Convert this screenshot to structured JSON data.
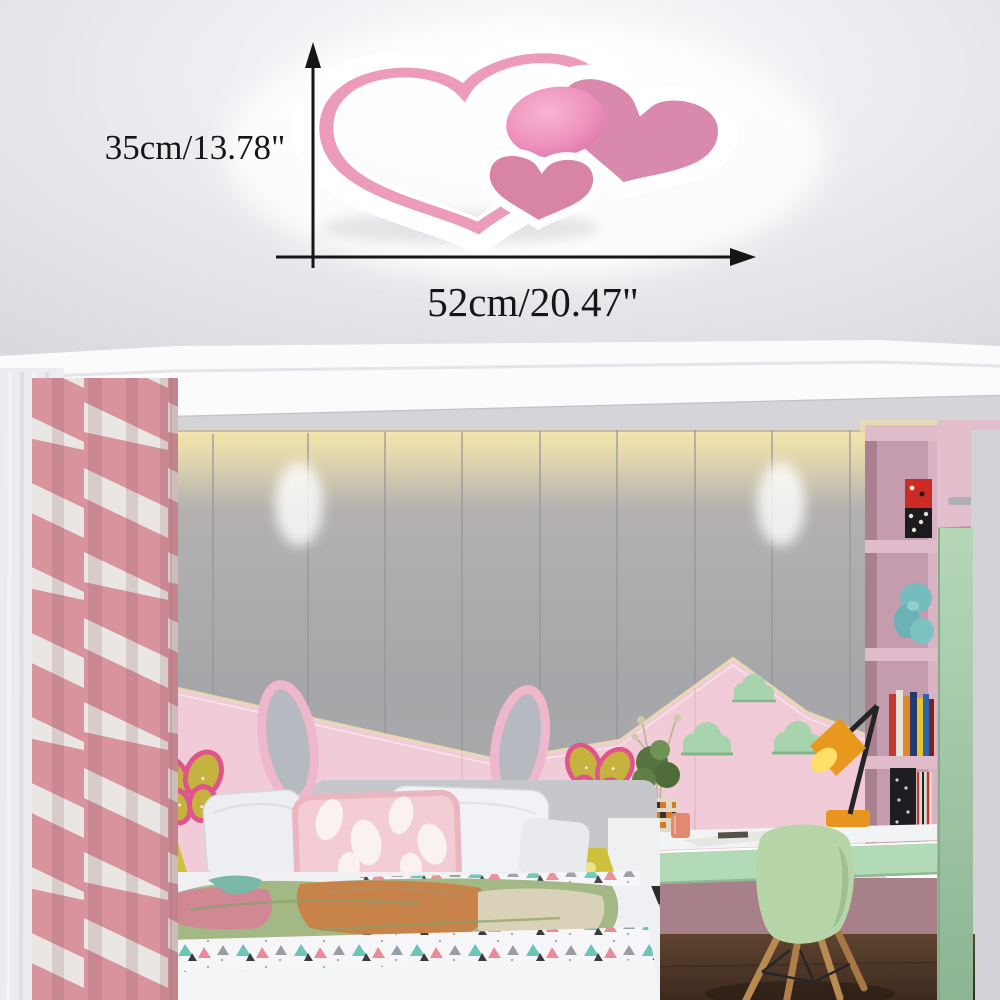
{
  "image": {
    "type": "product-photo",
    "subject": "pink heart-shaped LED ceiling lamp mounted on a bedroom ceiling",
    "setting": "children's bedroom with pastel pink decor"
  },
  "annotations": {
    "height_label": "35cm/13.78\"",
    "width_label": "52cm/20.47\""
  },
  "product": {
    "name": "heart ceiling light",
    "parts": [
      "large-outline-heart",
      "filled-heart-right",
      "small-filled-heart",
      "round-pink-dome"
    ],
    "colors": {
      "heart_pink": "#d98aac",
      "band_pink": "#ec9cba",
      "dome_pink": "#ef94bf",
      "border_white": "#ffffff"
    }
  },
  "palette": {
    "ceiling": "#e6e6ea",
    "cove_band": "#fbfbfc",
    "wall_panel": "#adadb1",
    "warm_glow": "#f3e2ac",
    "wainscot_pink": "#f2cbd8",
    "curtain_pink": "#d8939d",
    "butterfly_yellow": "#c6b23e",
    "butterfly_border": "#e0548c",
    "cloud_green": "#a7d3ad",
    "wardrobe_pink": "#e0bbca",
    "sliding_door_green": "#aacfae",
    "desk_drawer_green": "#b3dab6",
    "chair_green": "#b6d5a8",
    "desk_lamp_orange": "#e8951f",
    "bedside_lamp_yellow": "#cdc13c",
    "nightstand_dark": "#2e2a2a",
    "bed_white": "#eef0f3",
    "floor_brown": "#54392a",
    "annotation_ink": "#161616"
  },
  "scene_objects": [
    "heart-ceiling-lamp",
    "dimension-arrows",
    "cove-tray-ceiling",
    "panel-wall",
    "sheer-curtain",
    "pink-striped-curtain",
    "pink-wainscot-panels",
    "butterfly-decor-left",
    "butterfly-decor-right",
    "cloud-shelves",
    "bunny-ear-headboard",
    "bed-with-pillows",
    "patterned-blanket",
    "triangle-print-duvet",
    "nightstands",
    "bedside-lamps",
    "desk",
    "desk-lamp",
    "potted-plant",
    "shell-chair",
    "wardrobe-shelves",
    "books",
    "plush-toy",
    "green-sliding-door",
    "wood-floor"
  ]
}
